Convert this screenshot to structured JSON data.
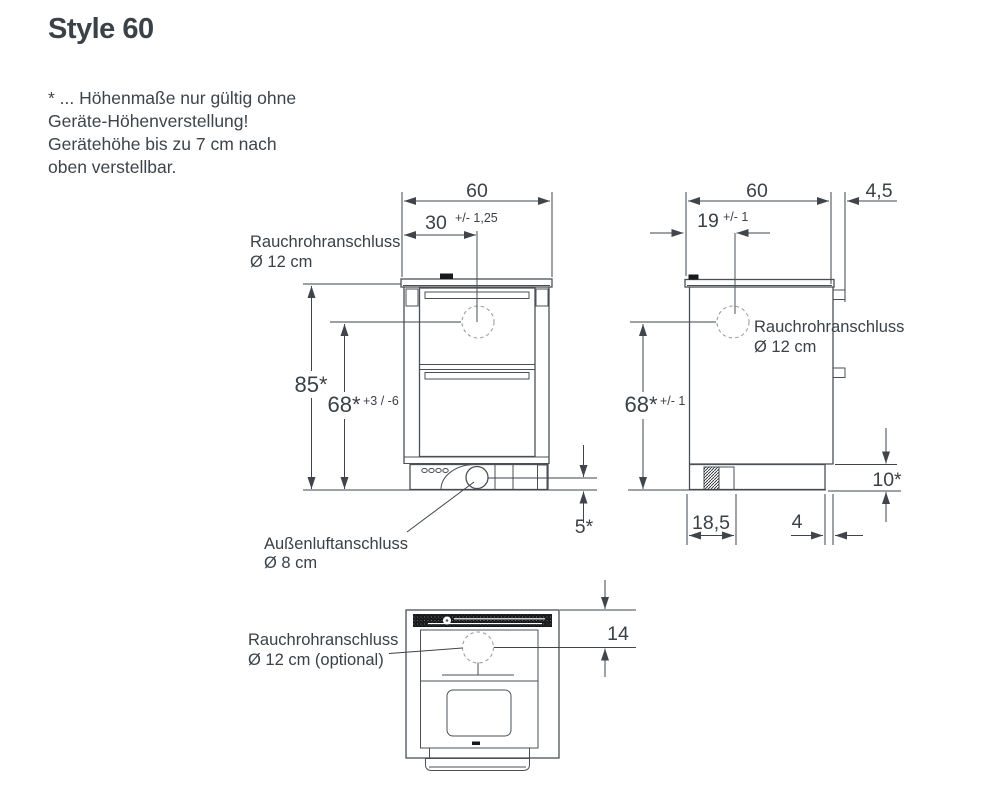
{
  "title": "Style 60",
  "note_lines": [
    "* ... Höhenmaße nur gültig ohne",
    "Geräte-Höhenverstellung!",
    "Gerätehöhe bis zu 7 cm nach",
    "oben verstellbar."
  ],
  "front": {
    "width": "60",
    "flue_offset": "30",
    "flue_offset_tol": "+/- 1,25",
    "height_total": "85*",
    "height_flue": "68*",
    "height_flue_tol": "+3 / -6",
    "air_height": "5*",
    "flue_label": "Rauchrohranschluss",
    "flue_dia": "Ø 12 cm",
    "air_label": "Außenluftanschluss",
    "air_dia": "Ø 8 cm"
  },
  "side": {
    "depth": "60",
    "rear_gap": "4,5",
    "flue_offset": "19",
    "flue_offset_tol": "+/- 1",
    "height_flue": "68*",
    "height_flue_tol": "+/- 1",
    "base_height": "10*",
    "base_front": "18,5",
    "base_rear": "4",
    "flue_label": "Rauchrohranschluss",
    "flue_dia": "Ø 12 cm"
  },
  "top": {
    "flue_from_back": "14",
    "flue_label": "Rauchrohranschluss",
    "flue_dia": "Ø 12 cm (optional)"
  },
  "colors": {
    "text": "#3a4147",
    "line": "#4a5055",
    "dark": "#17191b",
    "background": "#ffffff"
  }
}
